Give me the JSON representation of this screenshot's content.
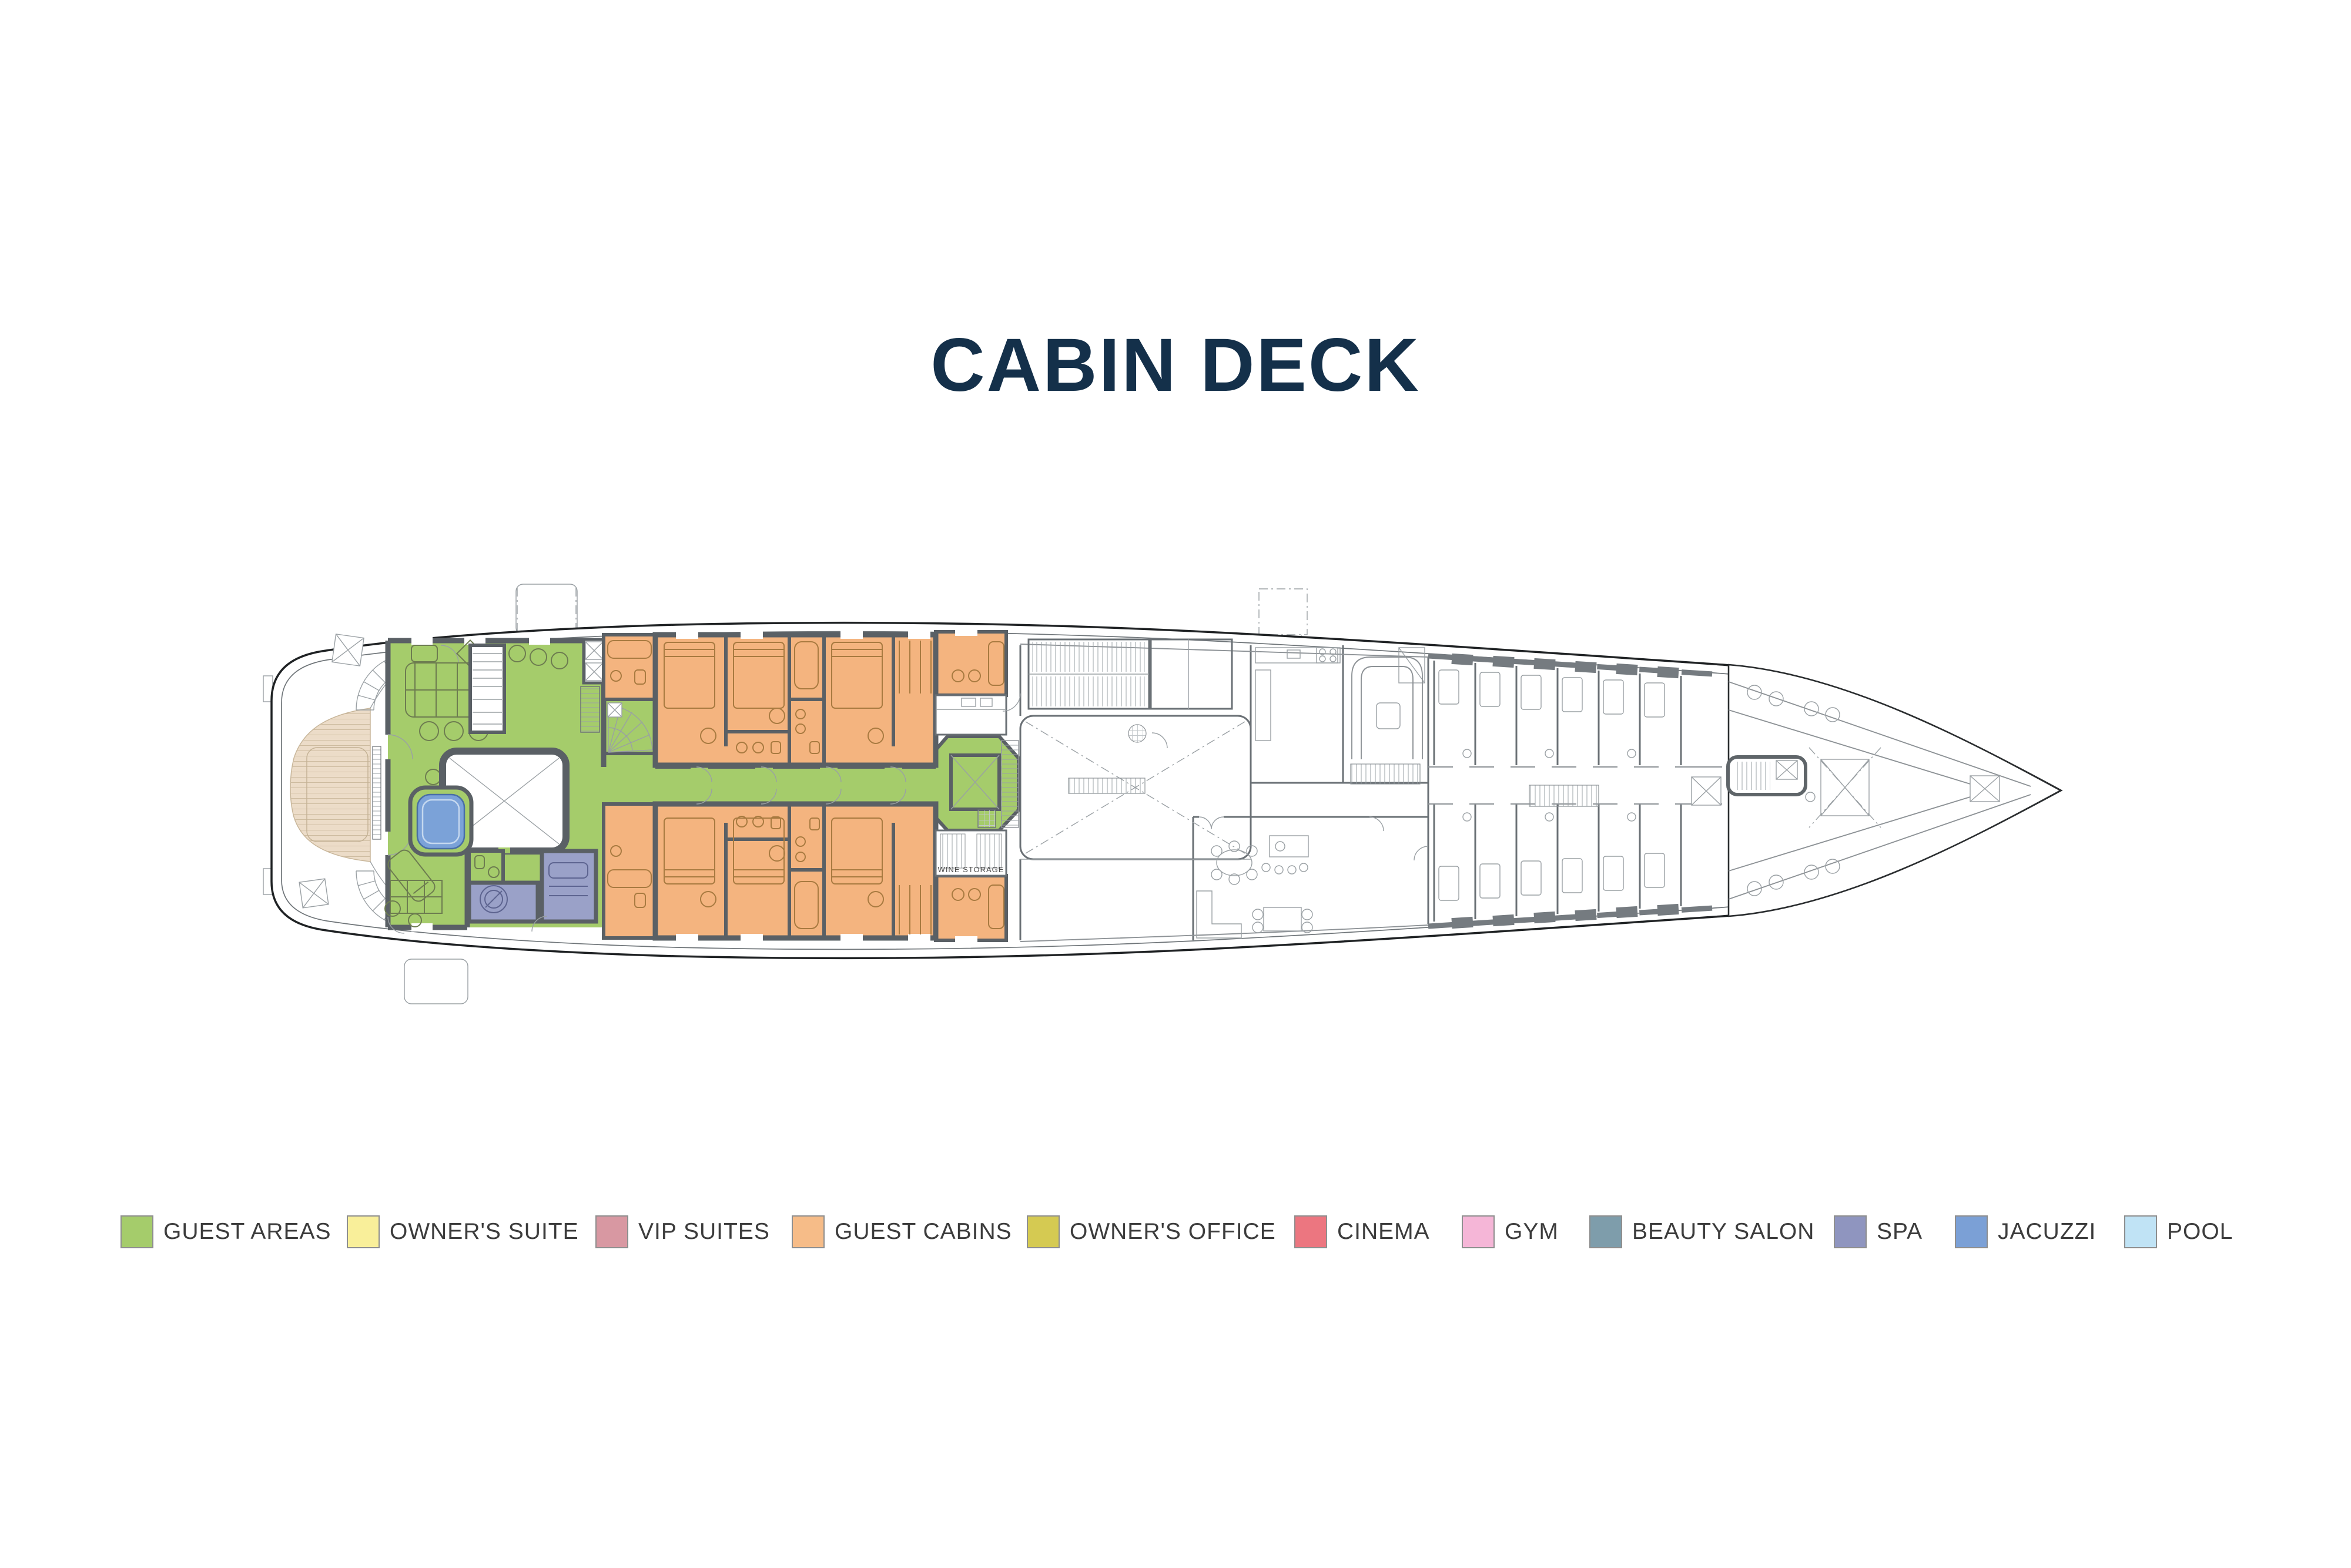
{
  "title": "CABIN DECK",
  "legend": {
    "items": [
      {
        "label": "GUEST AREAS",
        "color": "#a5cc6b"
      },
      {
        "label": "OWNER'S SUITE",
        "color": "#f9ef9a"
      },
      {
        "label": "VIP SUITES",
        "color": "#d898a2"
      },
      {
        "label": "GUEST CABINS",
        "color": "#f6bc88"
      },
      {
        "label": "OWNER'S OFFICE",
        "color": "#d5ca52"
      },
      {
        "label": "CINEMA",
        "color": "#ec7680"
      },
      {
        "label": "GYM",
        "color": "#f5b6d7"
      },
      {
        "label": "BEAUTY SALON",
        "color": "#7e9dab"
      },
      {
        "label": "SPA",
        "color": "#8f95bf"
      },
      {
        "label": "JACUZZI",
        "color": "#7ba0d6"
      },
      {
        "label": "POOL",
        "color": "#c0e3f5"
      }
    ]
  },
  "plan": {
    "labels": {
      "wine_storage": "WINE STORAGE"
    }
  },
  "colors": {
    "title": "#14304a",
    "text": "#3c3c3c",
    "hull": "#1f2224",
    "wall": "#5a6065",
    "wall_light": "#757b80",
    "green": "#a5cc6b",
    "orange": "#f4b47f",
    "spa": "#9aa1c8",
    "jacuzzi": "#7ba2d8",
    "jacuzzi_light": "#c5d8ef",
    "teak": "#ecdcc8"
  }
}
